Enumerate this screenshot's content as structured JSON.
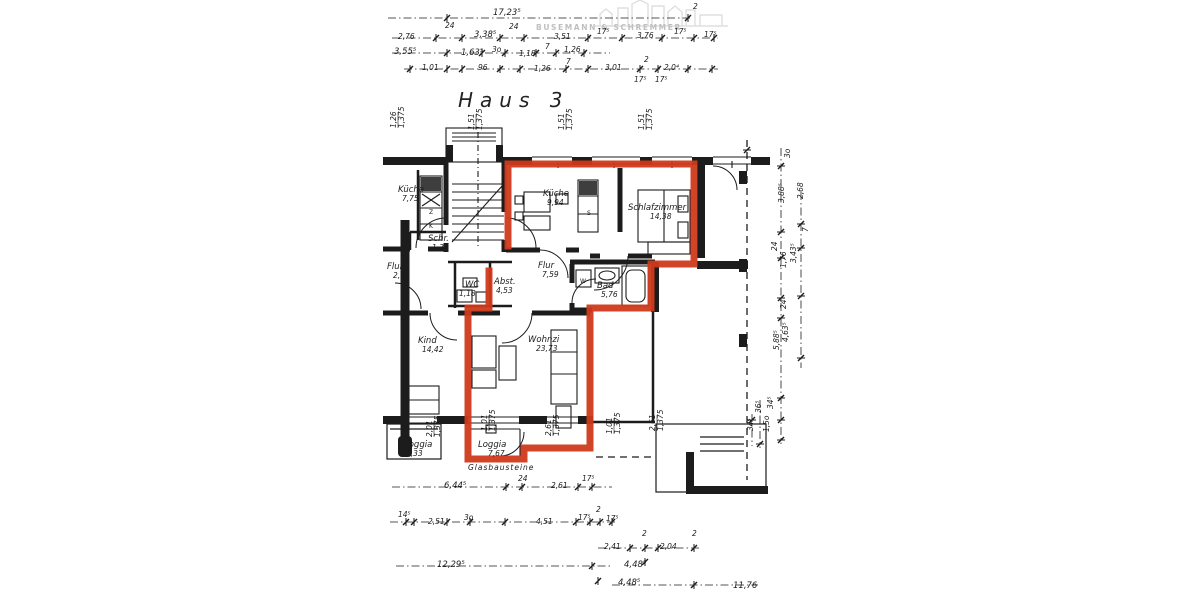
{
  "title": "Haus 3",
  "watermark": {
    "name": "BUSEMANN & SCHREMMER"
  },
  "colors": {
    "ink": "#1c1c1c",
    "highlight": "#cf3a1c",
    "watermark": "#bfbfbf",
    "paper": "#ffffff"
  },
  "rooms": [
    {
      "name": "Küche",
      "area": "7,75",
      "x": 398,
      "y": 192,
      "ax": 4
    },
    {
      "name": "Schr.",
      "area": "1,33",
      "x": 428,
      "y": 241,
      "ax": 4
    },
    {
      "name": "Küche",
      "area": "9,94",
      "x": 543,
      "y": 196,
      "ax": 4
    },
    {
      "name": "Schlafzimmer",
      "area": "14,38",
      "x": 628,
      "y": 210,
      "ax": 22
    },
    {
      "name": "Flur",
      "area": "2,64",
      "x": 387,
      "y": 269,
      "ax": 6
    },
    {
      "name": "Flur",
      "area": "7,59",
      "x": 538,
      "y": 268,
      "ax": 4
    },
    {
      "name": "WC",
      "area": "1,18",
      "x": 465,
      "y": 287,
      "ax": -6
    },
    {
      "name": "Abst.",
      "area": "4,53",
      "x": 494,
      "y": 284,
      "ax": 2
    },
    {
      "name": "Bad",
      "area": "5,76",
      "x": 597,
      "y": 288,
      "ax": 4
    },
    {
      "name": "Kind",
      "area": "14,42",
      "x": 418,
      "y": 343,
      "ax": 4
    },
    {
      "name": "Wohnzi",
      "area": "23,73",
      "x": 528,
      "y": 342,
      "ax": 8
    },
    {
      "name": "Loggia",
      "area": "3,33",
      "x": 404,
      "y": 447,
      "ax": 2
    },
    {
      "name": "Loggia",
      "area": "7,67",
      "x": 478,
      "y": 447,
      "ax": 10
    }
  ],
  "notes": [
    {
      "t": "Glasbausteine",
      "x": 468,
      "y": 470
    }
  ],
  "fixture_labels": [
    {
      "t": "Z",
      "x": 429,
      "y": 214
    },
    {
      "t": "K",
      "x": 429,
      "y": 228
    },
    {
      "t": "S",
      "x": 587,
      "y": 215
    },
    {
      "t": "W",
      "x": 580,
      "y": 283
    }
  ],
  "top_dims": [
    {
      "t": "17,23⁵",
      "x": 493,
      "y": 15
    },
    {
      "t": "2",
      "x": 693,
      "y": 9
    },
    {
      "t": "2,76",
      "x": 398,
      "y": 39
    },
    {
      "t": "24",
      "x": 445,
      "y": 28
    },
    {
      "t": "3,38⁵",
      "x": 474,
      "y": 37
    },
    {
      "t": "24",
      "x": 509,
      "y": 29
    },
    {
      "t": "3,51",
      "x": 554,
      "y": 39
    },
    {
      "t": "17⁵",
      "x": 597,
      "y": 34
    },
    {
      "t": "3,76",
      "x": 637,
      "y": 38
    },
    {
      "t": "17⁵",
      "x": 674,
      "y": 34
    },
    {
      "t": "17⁵",
      "x": 704,
      "y": 37
    },
    {
      "t": "3,55⁵",
      "x": 394,
      "y": 54
    },
    {
      "t": "1,63⁵",
      "x": 461,
      "y": 55
    },
    {
      "t": "3o",
      "x": 492,
      "y": 52
    },
    {
      "t": "1,18",
      "x": 519,
      "y": 56
    },
    {
      "t": "7",
      "x": 545,
      "y": 49
    },
    {
      "t": "1,26",
      "x": 564,
      "y": 52
    },
    {
      "t": "1,01",
      "x": 422,
      "y": 70
    },
    {
      "t": "96",
      "x": 478,
      "y": 70
    },
    {
      "t": "1,26",
      "x": 534,
      "y": 71
    },
    {
      "t": "7",
      "x": 566,
      "y": 64
    },
    {
      "t": "3,01",
      "x": 605,
      "y": 70
    },
    {
      "t": "2",
      "x": 644,
      "y": 62
    },
    {
      "t": "2,0⁴",
      "x": 664,
      "y": 70
    },
    {
      "t": "17⁵",
      "x": 634,
      "y": 82
    },
    {
      "t": "17⁵",
      "x": 655,
      "y": 82
    }
  ],
  "bottom_dims": [
    {
      "t": "6,44⁵",
      "x": 444,
      "y": 488
    },
    {
      "t": "24",
      "x": 518,
      "y": 481
    },
    {
      "t": "2,61",
      "x": 551,
      "y": 488
    },
    {
      "t": "17⁵",
      "x": 582,
      "y": 481
    },
    {
      "t": "14⁵",
      "x": 398,
      "y": 517
    },
    {
      "t": "2,51",
      "x": 428,
      "y": 524
    },
    {
      "t": "3o",
      "x": 464,
      "y": 520
    },
    {
      "t": "4,51",
      "x": 536,
      "y": 524
    },
    {
      "t": "17⁵",
      "x": 578,
      "y": 520
    },
    {
      "t": "2",
      "x": 596,
      "y": 512
    },
    {
      "t": "17⁵",
      "x": 606,
      "y": 521
    },
    {
      "t": "12,29⁵",
      "x": 437,
      "y": 567
    },
    {
      "t": "2,41",
      "x": 604,
      "y": 549
    },
    {
      "t": "2",
      "x": 642,
      "y": 536
    },
    {
      "t": "2,04",
      "x": 660,
      "y": 549
    },
    {
      "t": "2",
      "x": 692,
      "y": 536
    },
    {
      "t": "4,48⁵",
      "x": 624,
      "y": 567
    },
    {
      "t": "4,48⁵",
      "x": 618,
      "y": 585
    },
    {
      "t": "11,76",
      "x": 733,
      "y": 588
    }
  ],
  "right_dims": [
    {
      "t": "3o",
      "x": 790,
      "y": 158
    },
    {
      "t": "2,68",
      "x": 803,
      "y": 199
    },
    {
      "t": "3,88⁵",
      "x": 784,
      "y": 203
    },
    {
      "t": "7",
      "x": 808,
      "y": 232
    },
    {
      "t": "24",
      "x": 777,
      "y": 251
    },
    {
      "t": "3,43⁵",
      "x": 796,
      "y": 263
    },
    {
      "t": "1,76",
      "x": 786,
      "y": 268
    },
    {
      "t": "24",
      "x": 786,
      "y": 309
    },
    {
      "t": "4,63⁵",
      "x": 788,
      "y": 342
    },
    {
      "t": "5,88⁵",
      "x": 779,
      "y": 350
    },
    {
      "t": "34⁵",
      "x": 773,
      "y": 409
    },
    {
      "t": "36⁵",
      "x": 761,
      "y": 413
    },
    {
      "t": "1,5o",
      "x": 769,
      "y": 432
    },
    {
      "t": "34⁵",
      "x": 753,
      "y": 431
    }
  ],
  "window_dims": [
    {
      "a": "1,26",
      "b": "1,375",
      "x": 396,
      "y": 128
    },
    {
      "a": "1,51",
      "b": "1,375",
      "x": 474,
      "y": 130
    },
    {
      "a": "1,51",
      "b": "1,375",
      "x": 564,
      "y": 130
    },
    {
      "a": "1,51",
      "b": "1,375",
      "x": 644,
      "y": 130
    },
    {
      "a": "2,01",
      "b": "1,375",
      "x": 432,
      "y": 437
    },
    {
      "a": "1,01",
      "b": "1,375",
      "x": 487,
      "y": 431
    },
    {
      "a": "2,61",
      "b": "1,375",
      "x": 551,
      "y": 436
    },
    {
      "a": "1,01",
      "b": "1,375",
      "x": 612,
      "y": 434
    },
    {
      "a": "2,61",
      "b": "1,375",
      "x": 655,
      "y": 431
    }
  ]
}
